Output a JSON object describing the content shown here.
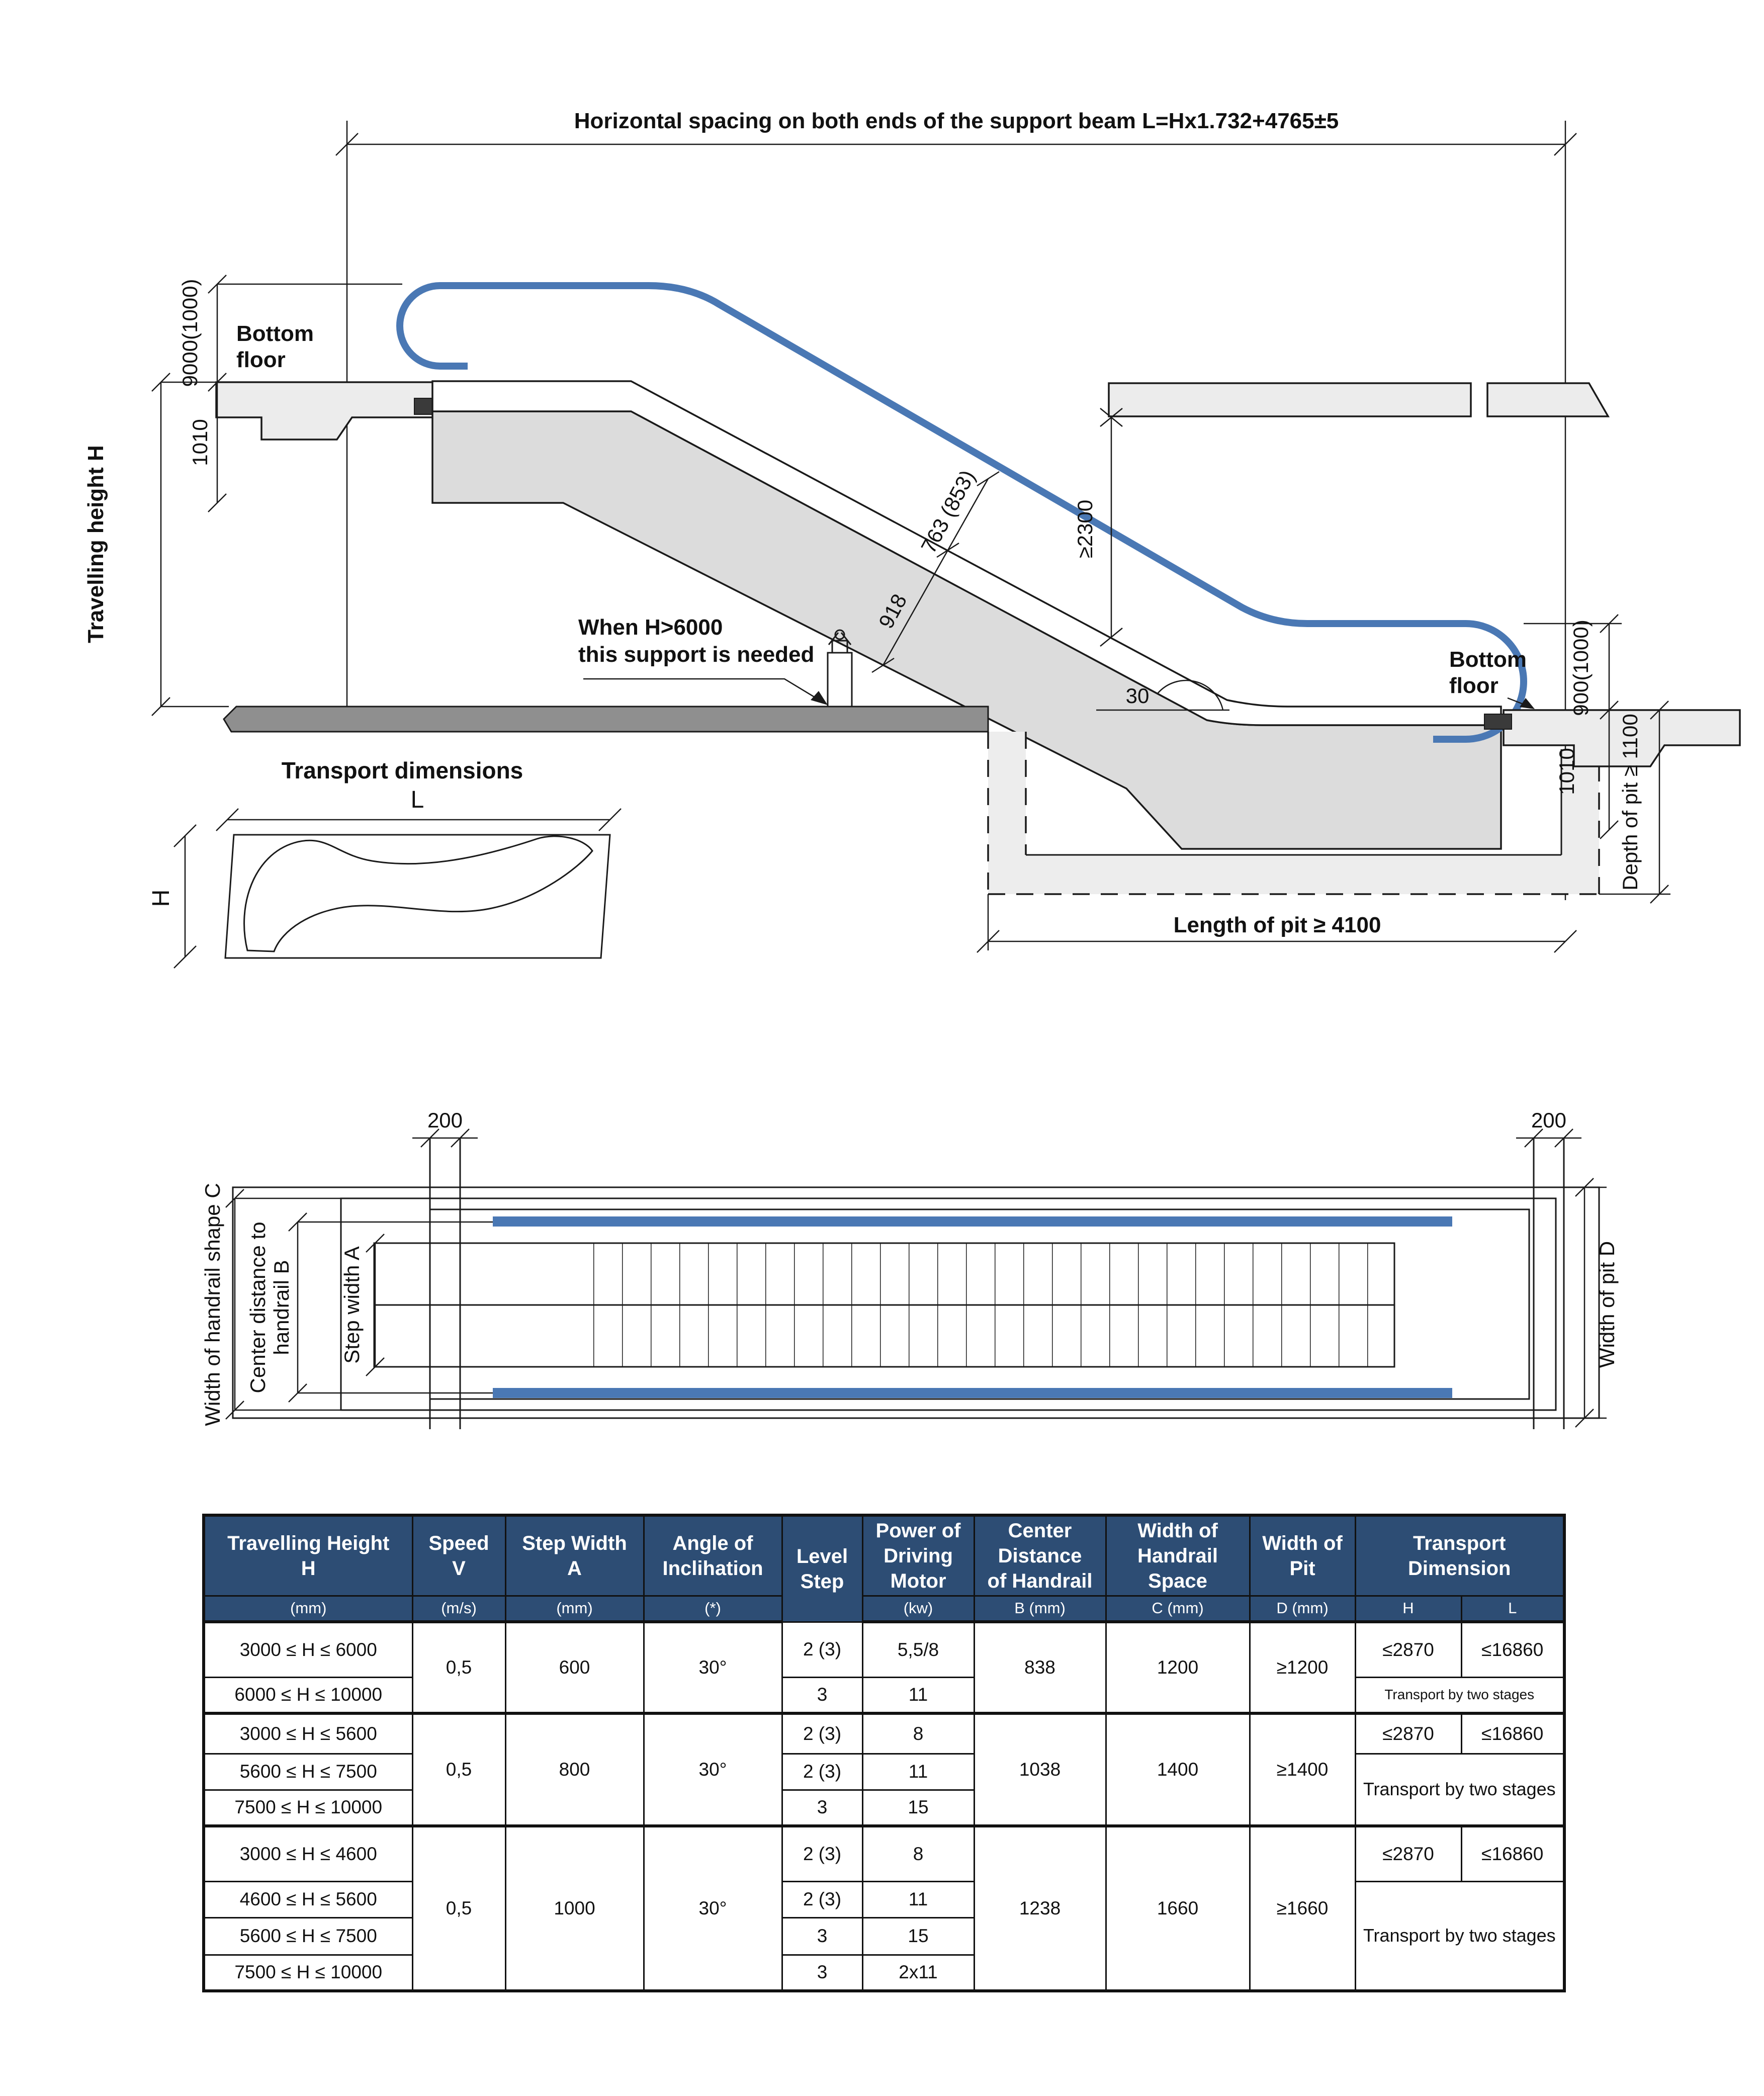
{
  "colors": {
    "accent_blue": "#4a78b4",
    "table_header_bg": "#2d4d74",
    "table_header_text": "#ffffff",
    "line": "#1a1a1a",
    "truss_gray": "#dcdcdc",
    "floor_gray": "#ececec",
    "ground_dark": "#8f8f8f",
    "pit_gray": "#ededed"
  },
  "side_view": {
    "top_dim": "Horizontal spacing on both ends of the support beam L=Hx1.732+4765±5",
    "left_handrail_dim": "9000(1000)",
    "bottom_floor_left": [
      "Bottom",
      "floor"
    ],
    "left_truss_depth": "1010",
    "travelling_height": "Travelling height H",
    "support_note": [
      "When H>6000",
      "this support is needed"
    ],
    "incline_dim_upper": "763 (853)",
    "incline_dim_lower": "918",
    "headroom_dim": "≥2300",
    "angle_label": "30",
    "bottom_floor_right": [
      "Bottom",
      "floor"
    ],
    "right_handrail_dim": "900(1000)",
    "right_truss_depth": "1010",
    "pit_depth_dim": "Depth of pit ≥ 1100",
    "pit_length_dim": "Length of pit ≥ 4100",
    "transport_title": "Transport dimensions",
    "transport_length": "L",
    "transport_height": "H"
  },
  "plan_view": {
    "beam_dim_left": "200",
    "beam_dim_right": "200",
    "handrail_shape_width": "Width of handrail shape C",
    "center_distance": [
      "Center distance to",
      "handrail B"
    ],
    "step_width": "Step width A",
    "pit_width": "Width of pit D"
  },
  "table": {
    "headers": {
      "travelling": [
        "Travelling Height",
        "H"
      ],
      "speed": [
        "Speed",
        "V"
      ],
      "step_width": [
        "Step Width",
        "A"
      ],
      "angle": [
        "Angle of",
        "Inclihation"
      ],
      "level_step": [
        "Level",
        "Step"
      ],
      "power": [
        "Power of",
        "Driving",
        "Motor"
      ],
      "center_distance": [
        "Center",
        "Distance",
        "of Handrail"
      ],
      "handrail_space": [
        "Width of",
        "Handrail",
        "Space"
      ],
      "width_pit": [
        "Width of",
        "Pit"
      ],
      "transport": [
        "Transport",
        "Dimension"
      ]
    },
    "units": {
      "travelling": "(mm)",
      "speed": "(m/s)",
      "step_width": "(mm)",
      "angle": "(*)",
      "power": "(kw)",
      "center_distance": "B (mm)",
      "handrail_space": "C (mm)",
      "width_pit": "D (mm)",
      "transport_h": "H",
      "transport_l": "L"
    },
    "groups": [
      {
        "speed": "0,5",
        "step_width": "600",
        "angle": "30°",
        "center_distance": "838",
        "handrail_space": "1200",
        "width_pit": "≥1200",
        "transport_h": "≤2870",
        "transport_l": "≤16860",
        "transport_note": "Transport by two stages",
        "rows": [
          {
            "height": "3000 ≤ H ≤ 6000",
            "level_step": "2 (3)",
            "power": "5,5/8"
          },
          {
            "height": "6000 ≤ H ≤ 10000",
            "level_step": "3",
            "power": "11"
          }
        ]
      },
      {
        "speed": "0,5",
        "step_width": "800",
        "angle": "30°",
        "center_distance": "1038",
        "handrail_space": "1400",
        "width_pit": "≥1400",
        "transport_h": "≤2870",
        "transport_l": "≤16860",
        "transport_note": "Transport by two stages",
        "rows": [
          {
            "height": "3000 ≤ H ≤ 5600",
            "level_step": "2 (3)",
            "power": "8"
          },
          {
            "height": "5600 ≤ H ≤ 7500",
            "level_step": "2 (3)",
            "power": "11"
          },
          {
            "height": "7500 ≤ H ≤ 10000",
            "level_step": "3",
            "power": "15"
          }
        ]
      },
      {
        "speed": "0,5",
        "step_width": "1000",
        "angle": "30°",
        "center_distance": "1238",
        "handrail_space": "1660",
        "width_pit": "≥1660",
        "transport_h": "≤2870",
        "transport_l": "≤16860",
        "transport_note": "Transport by two stages",
        "rows": [
          {
            "height": "3000 ≤ H ≤ 4600",
            "level_step": "2 (3)",
            "power": "8"
          },
          {
            "height": "4600 ≤ H ≤ 5600",
            "level_step": "2 (3)",
            "power": "11"
          },
          {
            "height": "5600 ≤ H ≤ 7500",
            "level_step": "3",
            "power": "15"
          },
          {
            "height": "7500 ≤ H ≤ 10000",
            "level_step": "3",
            "power": "2x11"
          }
        ]
      }
    ]
  }
}
